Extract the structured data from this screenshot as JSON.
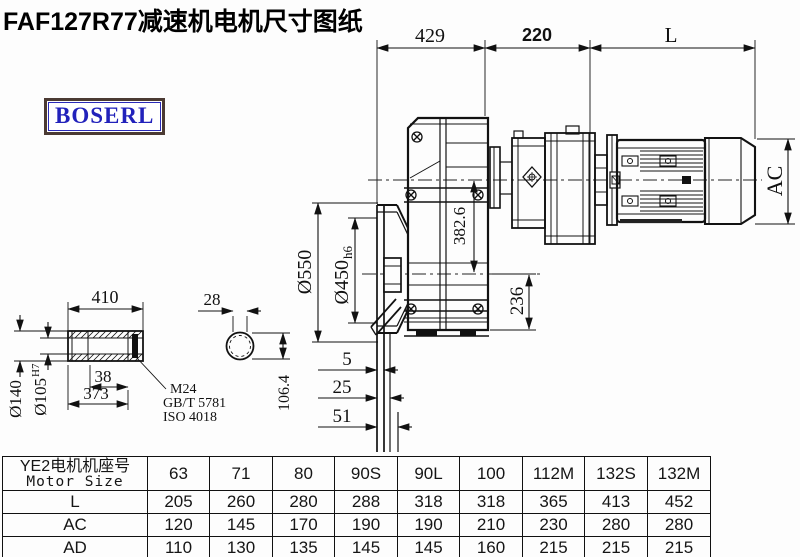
{
  "title": "FAF127R77减速机电机尺寸图纸",
  "brand": "BOSERL",
  "drawing": {
    "dims": {
      "top_width": "429",
      "mid_width": "220",
      "motor_length": "L",
      "motor_od": "AC",
      "center_offset": "382.6",
      "base_height": "236",
      "flange_od": "Ø550",
      "flange_spigot": "Ø450",
      "flange_spigot_tol": "h6",
      "offset_5": "5",
      "offset_25": "25",
      "offset_51": "51"
    },
    "shaft": {
      "length": "410",
      "end_width": "28",
      "od": "Ø140",
      "bore": "Ø105",
      "bore_tol": "H7",
      "key_width": "38",
      "bore_depth": "373",
      "thread": "M24",
      "std_gb": "GB/T 5781",
      "std_iso": "ISO 4018",
      "flat_height": "106.4"
    }
  },
  "table": {
    "header_cn": "YE2电机机座号",
    "header_en": "Motor Size",
    "columns": [
      "63",
      "71",
      "80",
      "90S",
      "90L",
      "100",
      "112M",
      "132S",
      "132M"
    ],
    "rows": [
      {
        "label": "L",
        "values": [
          "205",
          "260",
          "280",
          "288",
          "318",
          "318",
          "365",
          "413",
          "452"
        ]
      },
      {
        "label": "AC",
        "values": [
          "120",
          "145",
          "170",
          "190",
          "190",
          "210",
          "230",
          "280",
          "280"
        ]
      },
      {
        "label": "AD",
        "values": [
          "110",
          "130",
          "135",
          "145",
          "145",
          "160",
          "215",
          "215",
          "215"
        ]
      }
    ]
  }
}
